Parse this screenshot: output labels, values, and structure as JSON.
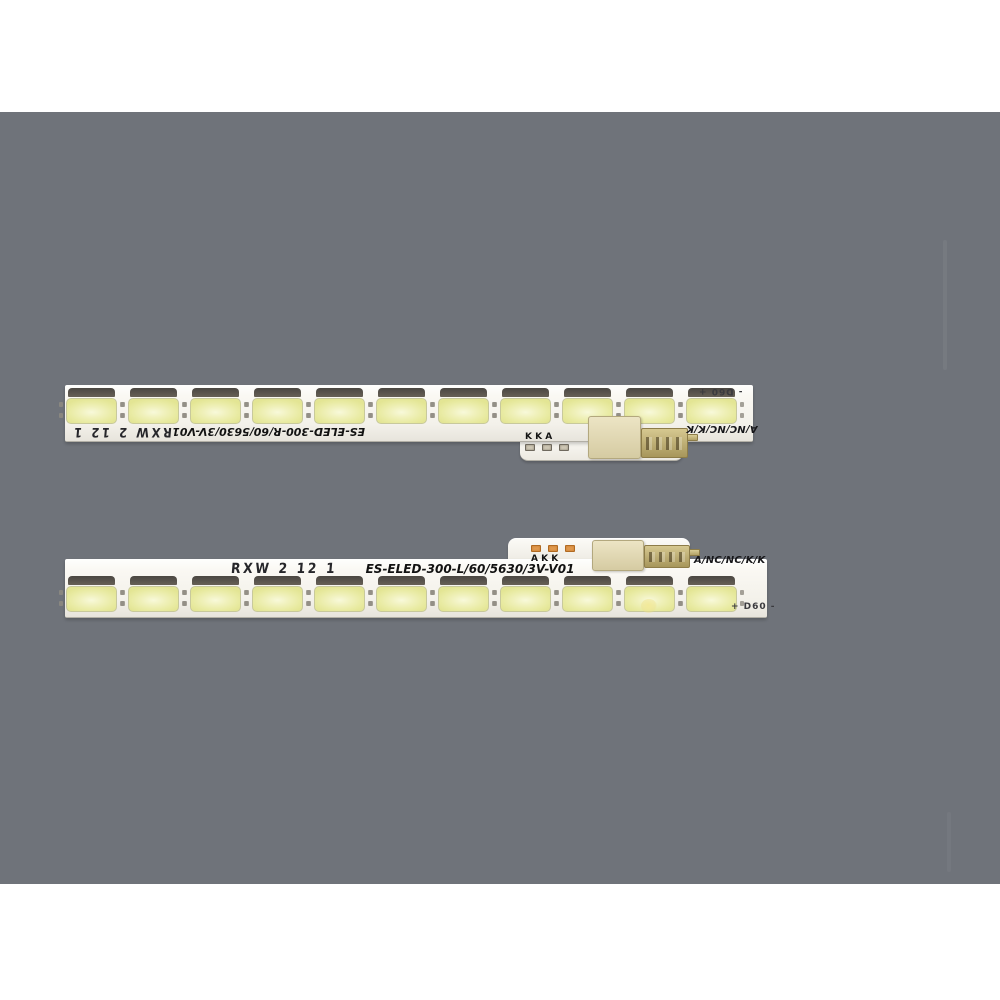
{
  "photo": {
    "subject": "two-tv-led-backlight-strips",
    "led_style": "5630 SMD"
  },
  "colors": {
    "page_background": "#ffffff",
    "photo_background": "#6f737a",
    "strip_white": "#f7f5ef",
    "led_face_yellow": "#eef0ae",
    "led_band_dark": "#4e4a44",
    "connector_beige": "#ddd3ad",
    "connector_gold": "#bfae74",
    "pad_orange": "#cd7a2e",
    "text_black": "#141414"
  },
  "strips": {
    "top": {
      "side": "upper strip (rotated 180°)",
      "model_label": "ES-ELED-300-R/60/5630/3V-V01",
      "handwritten_label": "RXW 2 12 1",
      "pin_label": "A/NC/NC/K/K",
      "polarity_label": "- D60 +",
      "pad_letters": "K K A",
      "led_count": 11
    },
    "bottom": {
      "side": "lower strip (upright)",
      "model_label": "ES-ELED-300-L/60/5630/3V-V01",
      "handwritten_label": "RXW 2 12 1",
      "pin_label": "A/NC/NC/K/K",
      "polarity_label": "+ D60 -",
      "pad_letters": "A K K",
      "led_count": 11
    }
  }
}
